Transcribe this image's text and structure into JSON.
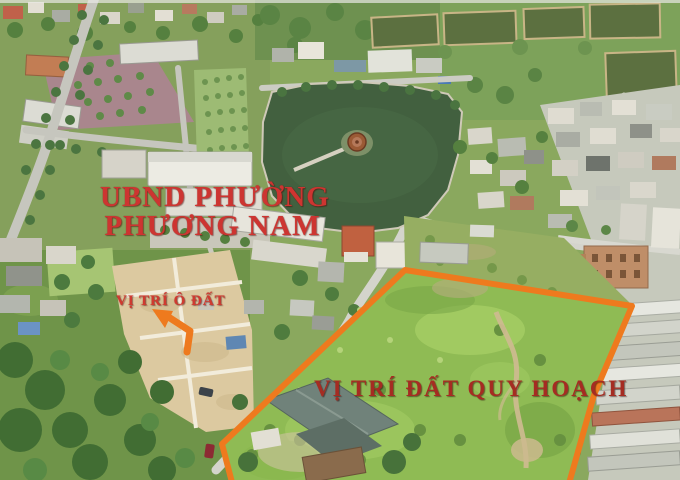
{
  "colors": {
    "boundary-orange": "#ee7a1e",
    "ward-label-red": "#cd3531",
    "plot-label-red": "#d03a30",
    "planned-label-red": "#a52c22"
  },
  "annotations": {
    "ward_label_line1": "UBND PHƯỜNG",
    "ward_label_line2": "PHƯƠNG NAM",
    "plot_label": "VỊ TRÍ Ô ĐẤT",
    "planned_area_label": "VỊ TRÍ ĐẤT QUY HOẠCH"
  }
}
